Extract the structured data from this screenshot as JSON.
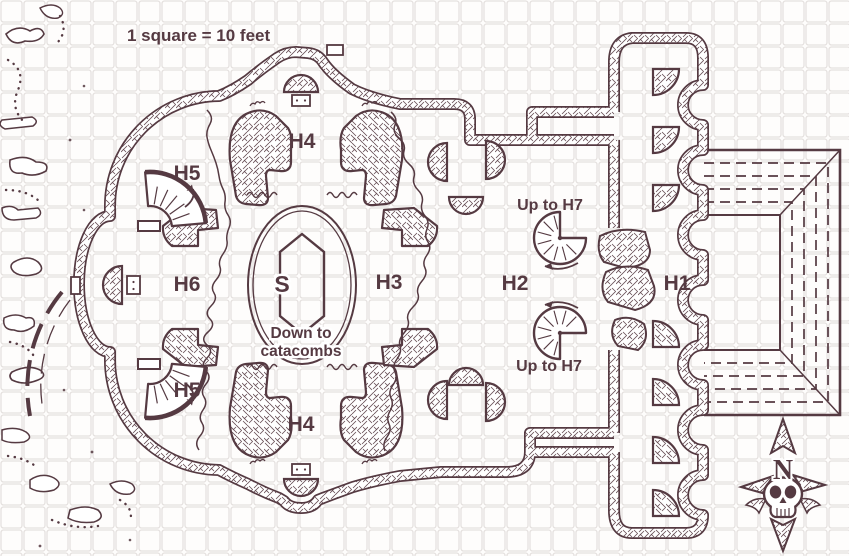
{
  "map": {
    "scale_label": "1 square = 10 feet",
    "colors": {
      "ink": "#553a42",
      "grid": "#e5e1df",
      "paper": "#fefdfc"
    },
    "rooms": {
      "h1": "H1",
      "h2": "H2",
      "h3": "H3",
      "h4_top": "H4",
      "h4_bottom": "H4",
      "h5_top": "H5",
      "h5_bottom": "H5",
      "h6": "H6",
      "stairs_marker": "S"
    },
    "annotations": {
      "up_to_h7_top": "Up to H7",
      "up_to_h7_bottom": "Up to H7",
      "down_to_catacombs_line1": "Down to",
      "down_to_catacombs_line2": "catacombs"
    },
    "compass": {
      "north_label": "N"
    },
    "icons": {
      "compass": "compass-skull-icon",
      "spiral_stair": "spiral-stair-icon",
      "curved_stair": "curved-stair-icon",
      "grand_staircase": "stepped-staircase",
      "dais": "hexagonal-dais",
      "altar": "altar-marker",
      "door": "door-marker"
    }
  }
}
